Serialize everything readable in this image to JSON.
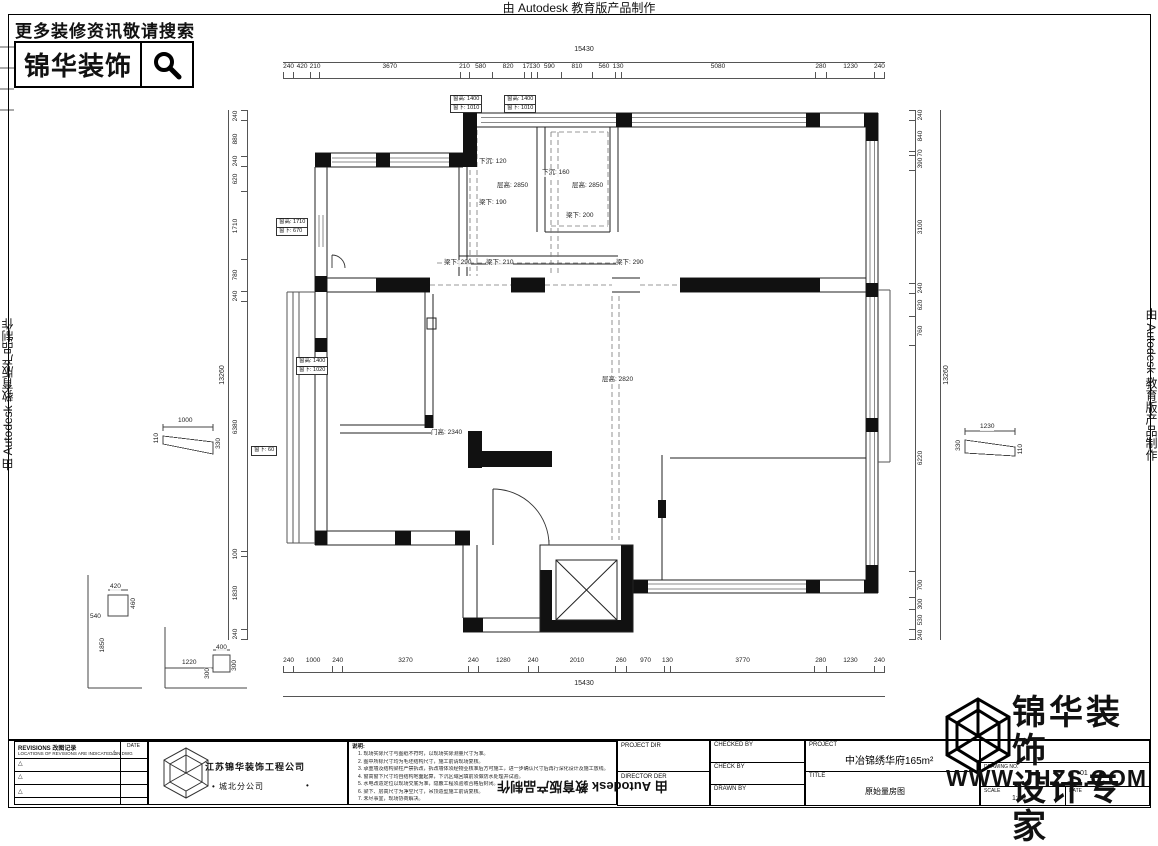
{
  "autodesk_note": "由 Autodesk 教育版产品制作",
  "header": {
    "search_hint": "更多装修资讯敬请搜索",
    "brand": "锦华装饰"
  },
  "watermark": {
    "brand_line1": "锦华装饰",
    "brand_line2": "设计专家",
    "website": "WWW.JHZS.COM"
  },
  "plan": {
    "dims_top": {
      "total": "15430",
      "segments": [
        "240",
        "420",
        "210",
        "3670",
        "210",
        "580",
        "820",
        "170",
        "130",
        "590",
        "810",
        "560",
        "130",
        "5080",
        "280",
        "1230",
        "240"
      ]
    },
    "dims_bottom": {
      "total": "15430",
      "segments": [
        "240",
        "1000",
        "240",
        "3270",
        "240",
        "1280",
        "240",
        "2010",
        "260",
        "970",
        "130",
        "3770",
        "280",
        "1230",
        "240"
      ]
    },
    "dims_left": {
      "total": "13260",
      "segments": [
        "240",
        "880",
        "240",
        "620",
        "1710",
        "780",
        "240",
        "6380",
        "100",
        "1830",
        "240"
      ]
    },
    "dims_right": {
      "total": "13260",
      "segments": [
        "240",
        "840",
        "70",
        "390",
        "3100",
        "240",
        "620",
        "760",
        "6220",
        "700",
        "300",
        "530",
        "240"
      ]
    },
    "window_tags": [
      {
        "l1": "窗高: 1400",
        "l2": "窗下: 1010"
      },
      {
        "l1": "窗高: 1400",
        "l2": "窗下: 1010"
      },
      {
        "l1": "窗高: 1710",
        "l2": "窗下: 670"
      },
      {
        "l1": "窗高: 1400",
        "l2": "窗下: 1020"
      },
      {
        "l1": "窗下: 60"
      }
    ],
    "labels": [
      {
        "text": "下沉: 120"
      },
      {
        "text": "层高: 2850"
      },
      {
        "text": "梁下: 190"
      },
      {
        "text": "下沉: 160"
      },
      {
        "text": "层高: 2850"
      },
      {
        "text": "梁下: 200"
      },
      {
        "text": "梁下: 290"
      },
      {
        "text": "梁下: 210"
      },
      {
        "text": "梁下: 290"
      },
      {
        "text": "层高: 2820"
      },
      {
        "text": "门高: 2340"
      }
    ],
    "aux": {
      "lt_top": "1000",
      "lt_left": "110",
      "lt_right": "330",
      "rt_top": "1230",
      "rt_left": "330",
      "rt_right": "110",
      "f1_top": "420",
      "f1_right": "460",
      "f1_left": "540",
      "f1_bottom": "1850",
      "f2_w": "1220",
      "f2_top": "400",
      "f2_h1": "300",
      "f2_h2": "300"
    }
  },
  "titleblock": {
    "revisions": {
      "title": "REVISIONS 改图记录",
      "subtitle": "LOCATIONS OF REVISIONS ARE INDICATED ON DWG",
      "date_label": "DATE",
      "triangle": "△"
    },
    "company": {
      "name": "江苏锦华装饰工程公司",
      "branch": "• 城北分公司",
      "dot": "•"
    },
    "notes": {
      "header": "说明:",
      "items": [
        "现场实际尺寸与图纸不符时，以现场实际测量尺寸为准。",
        "图中所标尺寸均为毛坯结构尺寸，施工前请现场复核。",
        "承重墙及结构梁柱严禁拆改，拆改墙体须经物业核准后方可施工，进一步确认尺寸后再行深化设计及施工放线。",
        "窗高窗下尺寸均自结构地面起算，下沉区域回填前须做防水处理并试验。",
        "水电改造定位以现场交底为准，隐蔽工程须验收合格后封闭。",
        "梁下、层高尺寸为净空尺寸，吊顶造型施工前请复核。",
        "未尽事宜，现场协商解决。"
      ]
    },
    "fields": {
      "project_dir": "PROJECT DIR",
      "director_der": "DIRECTOR DER",
      "checked_by": "CHECKED BY",
      "check_by": "CHECK BY",
      "drawn_by": "DRAWN BY",
      "project_label": "PROJECT",
      "project_value": "中冶锦绣华府165m²",
      "title_label": "TITLE",
      "title_value": "原始量房图",
      "drawing_no_label": "DRAWING NO.",
      "drawing_no_value": "01",
      "scale_label": "SCALE",
      "scale_value": "1:80",
      "date_label": "DATE"
    }
  }
}
